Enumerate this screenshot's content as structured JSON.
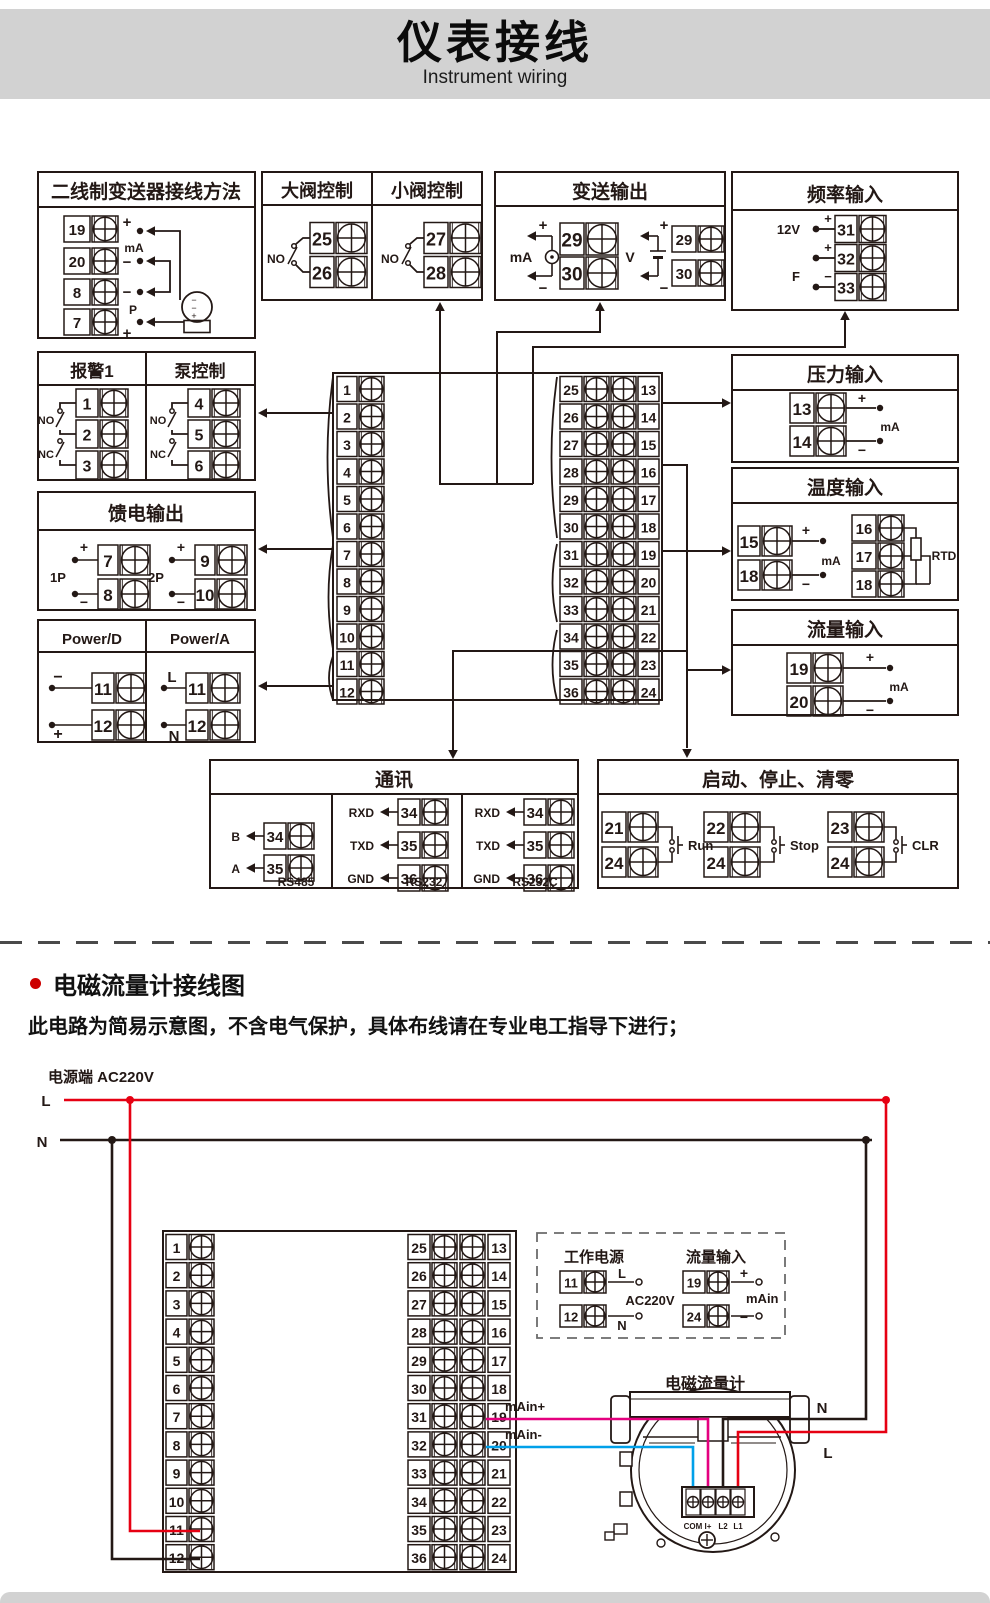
{
  "banner": {
    "title": "仪表接线",
    "subtitle": "Instrument wiring"
  },
  "colors": {
    "ink": "#231815",
    "red": "#e60012",
    "pink": "#e4007f",
    "blue": "#00a0e9",
    "banner_bg": "#d2d2d2"
  },
  "sym": {
    "plus": "+",
    "minus": "−"
  },
  "strip": {
    "left": [
      "1",
      "2",
      "3",
      "4",
      "5",
      "6",
      "7",
      "8",
      "9",
      "10",
      "11",
      "12"
    ],
    "mid": [
      "25",
      "26",
      "27",
      "28",
      "29",
      "30",
      "31",
      "32",
      "33",
      "34",
      "35",
      "36"
    ],
    "right": [
      "13",
      "14",
      "15",
      "16",
      "17",
      "18",
      "19",
      "20",
      "21",
      "22",
      "23",
      "24"
    ]
  },
  "boxes": {
    "two_wire": {
      "title": "二线制变送器接线方法",
      "terminals": [
        "19",
        "20",
        "8",
        "7"
      ],
      "mA": "mA",
      "P": "P"
    },
    "valve_big": {
      "title": "大阀控制",
      "no": "NO",
      "terminals": [
        "25",
        "26"
      ]
    },
    "valve_small": {
      "title": "小阀控制",
      "no": "NO",
      "terminals": [
        "27",
        "28"
      ]
    },
    "transmit_out": {
      "title": "变送输出",
      "mA": "mA",
      "V": "V",
      "terminals_mA": [
        "29",
        "30"
      ],
      "terminals_V": [
        "29",
        "30"
      ]
    },
    "freq_in": {
      "title": "频率输入",
      "v12": "12V",
      "f": "F",
      "terminals": [
        "31",
        "32",
        "33"
      ]
    },
    "alarm": {
      "title": "报警1",
      "no": "NO",
      "nc": "NC",
      "terminals": [
        "1",
        "2",
        "3"
      ]
    },
    "pump": {
      "title": "泵控制",
      "no": "NO",
      "nc": "NC",
      "terminals": [
        "4",
        "5",
        "6"
      ]
    },
    "feed_out": {
      "title": "馈电输出",
      "g1": "1P",
      "g2": "2P",
      "terminals": [
        "7",
        "8",
        "9",
        "10"
      ]
    },
    "power_d": {
      "title": "Power/D",
      "terminals": [
        "11",
        "12"
      ]
    },
    "power_a": {
      "title": "Power/A",
      "l": "L",
      "n": "N",
      "terminals": [
        "11",
        "12"
      ]
    },
    "pressure_in": {
      "title": "压力输入",
      "mA": "mA",
      "terminals": [
        "13",
        "14"
      ]
    },
    "temp_in": {
      "title": "温度输入",
      "mA": "mA",
      "rtd": "RTD",
      "terminals_left": [
        "15",
        "18"
      ],
      "terminals_right": [
        "16",
        "17",
        "18"
      ]
    },
    "flow_in": {
      "title": "流量输入",
      "mA": "mA",
      "terminals": [
        "19",
        "20"
      ]
    },
    "comm": {
      "title": "通讯",
      "groups": [
        {
          "pins": [
            "B",
            "A"
          ],
          "terms": [
            "34",
            "35"
          ],
          "label": "RS485"
        },
        {
          "pins": [
            "RXD",
            "TXD",
            "GND"
          ],
          "terms": [
            "34",
            "35",
            "36"
          ],
          "label": "RS232"
        },
        {
          "pins": [
            "RXD",
            "TXD",
            "GND"
          ],
          "terms": [
            "34",
            "35",
            "36"
          ],
          "label": "RS232C"
        }
      ]
    },
    "control": {
      "title": "启动、停止、清零",
      "groups": [
        {
          "terms": [
            "21",
            "24"
          ],
          "label": "Run"
        },
        {
          "terms": [
            "22",
            "24"
          ],
          "label": "Stop"
        },
        {
          "terms": [
            "23",
            "24"
          ],
          "label": "CLR"
        }
      ]
    }
  },
  "section2": {
    "heading": "电磁流量计接线图",
    "note": "此电路为简易示意图，不含电气保护，具体布线请在专业电工指导下进行；",
    "power_label": "电源端 AC220V",
    "l": "L",
    "n": "N",
    "dashed": {
      "left_title": "工作电源",
      "right_title": "流量输入",
      "rows_left": [
        {
          "t": "11",
          "tag": "L"
        },
        {
          "t": "12",
          "tag": "N"
        }
      ],
      "ac": "AC220V",
      "rows_right": [
        {
          "t": "19",
          "tag": "+"
        },
        {
          "t": "24",
          "tag": "−"
        }
      ],
      "mAin": "mAin"
    },
    "wire_plus": "mAin+",
    "wire_minus": "mAin-",
    "meter": {
      "title": "电磁流量计",
      "terminals": [
        "COM",
        "I+",
        "L2",
        "L1"
      ],
      "n": "N",
      "l": "L"
    }
  }
}
